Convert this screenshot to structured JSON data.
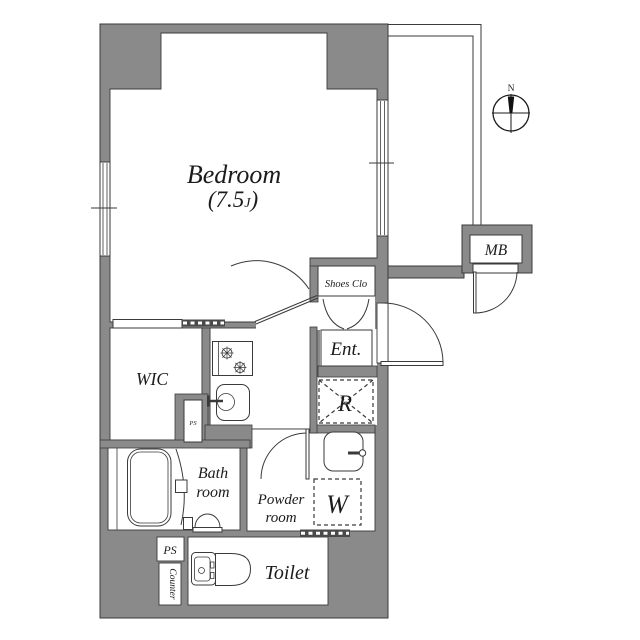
{
  "plan": {
    "rooms": {
      "bedroom": {
        "name": "Bedroom",
        "size_prefix": "(7.5",
        "size_unit": "J",
        "size_suffix": ")"
      },
      "wic": {
        "name": "WIC"
      },
      "shoes_closet": {
        "name": "Shoes Clo"
      },
      "entrance": {
        "name": "Ent."
      },
      "refrigerator_space": {
        "name": "R"
      },
      "washer_space": {
        "name": "W"
      },
      "bathroom": {
        "line1": "Bath",
        "line2": "room"
      },
      "powder_room": {
        "line1": "Powder",
        "line2": "room"
      },
      "toilet": {
        "name": "Toilet"
      },
      "meter_box": {
        "name": "MB"
      },
      "pipe_space_kitchen": {
        "name": "PS"
      },
      "pipe_space_toilet": {
        "name": "PS"
      },
      "counter": {
        "name": "Counter"
      }
    },
    "compass": {
      "north": "N"
    },
    "colors": {
      "wall": "#8a8a8a",
      "line": "#3a3a3a",
      "text": "#1b1b1b",
      "background": "#ffffff"
    }
  }
}
